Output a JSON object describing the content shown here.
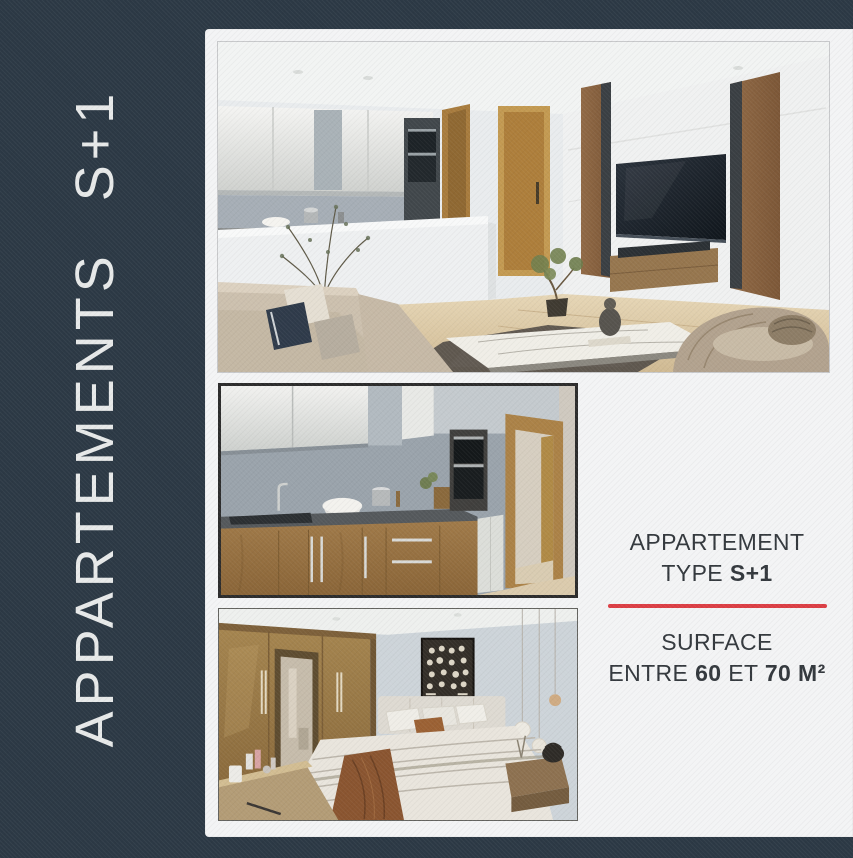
{
  "colors": {
    "bg-navy": "#2c3945",
    "panel-white": "#f3f4f5",
    "accent-red": "#dc3e44",
    "text-dark": "#33383d",
    "title-light": "#e7e9e9",
    "photo-border": "#2c2c2c"
  },
  "side_title": {
    "word1": "APPARTEMENTS",
    "word2": "S+1"
  },
  "photos": [
    {
      "name": "living-room",
      "desc": "Open-plan living room with kitchen bar, wall-mounted TV, sofa and marble coffee table"
    },
    {
      "name": "kitchen",
      "desc": "Kitchen with wooden lower cabinets, grey backsplash, built-in ovens and open wooden door"
    },
    {
      "name": "bedroom",
      "desc": "Bedroom with double bed, wardrobe, wall art and pendant lights"
    }
  ],
  "info": {
    "title_line1": "APPARTEMENT",
    "type_label": "TYPE",
    "type_value": "S+1",
    "surface_label": "SURFACE",
    "surface_prefix": "ENTRE",
    "surface_min": "60",
    "surface_conj": "ET",
    "surface_max": "70 M²"
  }
}
